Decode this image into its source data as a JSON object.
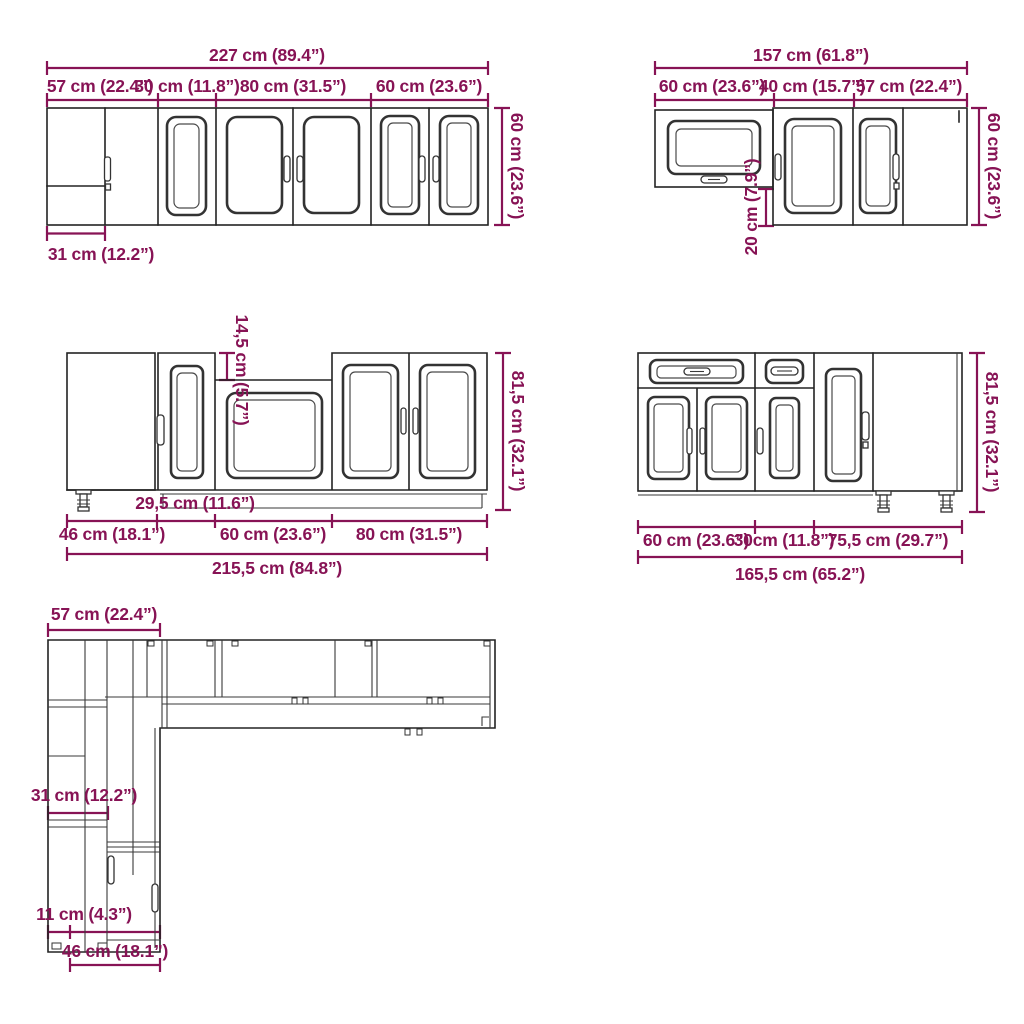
{
  "colors": {
    "dimension_text": "#871355",
    "line_art": "#232323"
  },
  "groups": {
    "wall_cabinets_left": {
      "total_width": "227 cm (89.4”)",
      "section_widths": [
        "57 cm (22.4”)",
        "30 cm (11.8”)",
        "80 cm (31.5”)",
        "60 cm (23.6”)"
      ],
      "height": "60 cm (23.6”)",
      "corner_side_width": "31 cm (12.2”)"
    },
    "wall_cabinets_right": {
      "total_width": "157 cm (61.8”)",
      "section_widths": [
        "60 cm (23.6”)",
        "40 cm (15.7”)",
        "57 cm (22.4”)"
      ],
      "height": "60 cm (23.6”)",
      "under_cabinet_gap": "20 cm (7.9”)"
    },
    "base_cabinets_left": {
      "counter_recess": "14,5 cm (5.7”)",
      "height": "81,5 cm (32.1”)",
      "narrow_unit_width": "29,5 cm (11.6”)",
      "section_widths": [
        "46 cm (18.1”)",
        "60 cm (23.6”)",
        "80 cm (31.5”)"
      ],
      "total_width": "215,5 cm (84.8”)"
    },
    "base_cabinets_right": {
      "height": "81,5 cm (32.1”)",
      "section_widths": [
        "60 cm (23.6”)",
        "30cm (11.8”)",
        "75,5 cm (29.7”)"
      ],
      "total_width": "165,5 cm (65.2”)"
    },
    "floor_plan": {
      "top_width": "57 cm (22.4”)",
      "side_depth": "31 cm (12.2”)",
      "corner_offset": "11 cm (4.3”)",
      "bottom_width": "46 cm (18.1”)"
    }
  }
}
